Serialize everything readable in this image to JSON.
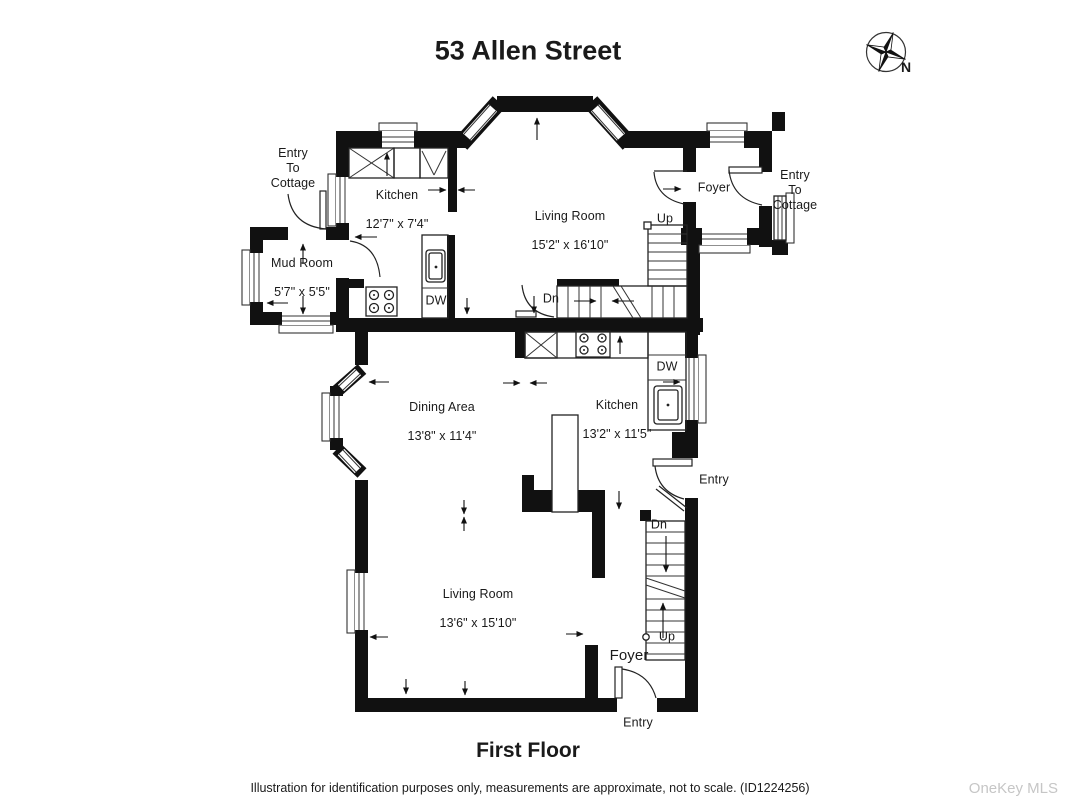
{
  "header": {
    "title": "53 Allen Street"
  },
  "compass": {
    "north_label": "N"
  },
  "plan": {
    "rooms": {
      "kitchen_upper": {
        "name": "Kitchen",
        "dims": "12'7\" x 7'4\""
      },
      "living_upper": {
        "name": "Living Room",
        "dims": "15'2\" x 16'10\""
      },
      "mud_room": {
        "name": "Mud Room",
        "dims": "5'7\" x 5'5\""
      },
      "foyer_upper": {
        "name": "Foyer"
      },
      "dining_area": {
        "name": "Dining Area",
        "dims": "13'8\" x 11'4\""
      },
      "kitchen_lower": {
        "name": "Kitchen",
        "dims": "13'2\" x 11'5\""
      },
      "living_lower": {
        "name": "Living Room",
        "dims": "13'6\" x 15'10\""
      },
      "foyer_lower": {
        "name": "Foyer"
      }
    },
    "annotations": {
      "entry_to_cottage_upper_left": "Entry\nTo\nCottage",
      "entry_to_cottage_upper_right": "Entry\nTo\nCottage",
      "up_upper": "Up",
      "dn_upper": "Dn",
      "dw_upper": "DW",
      "dw_lower": "DW",
      "entry_mid": "Entry",
      "dn_lower": "Dn",
      "up_lower": "Up",
      "entry_bottom": "Entry"
    }
  },
  "footer": {
    "floor_label": "First Floor",
    "disclaimer": "Illustration for identification purposes only, measurements are approximate, not to scale. (ID1224256)",
    "watermark": "OneKey MLS"
  },
  "colors": {
    "wall": "#111111",
    "line": "#222222",
    "text": "#1a1a1a",
    "watermark": "#c6c6c6"
  }
}
